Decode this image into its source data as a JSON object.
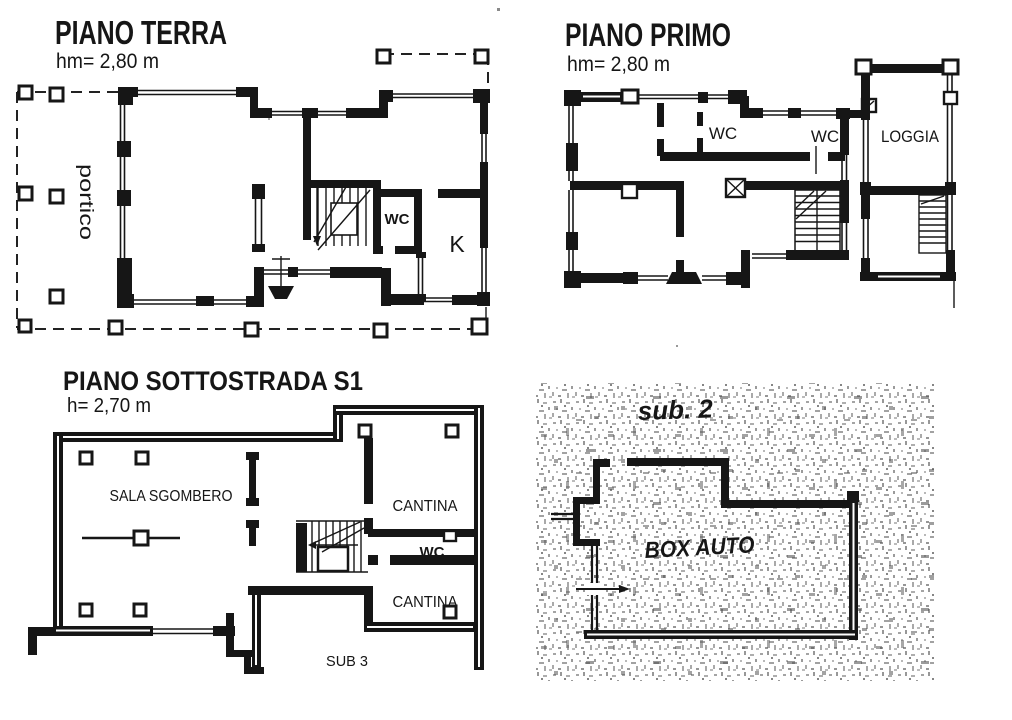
{
  "ink_color": "#161616",
  "plans": {
    "terra": {
      "title": "PIANO TERRA",
      "height_label": "hm= 2,80 m",
      "rooms": {
        "portico": "portico",
        "wc": "WC",
        "kitchen": "K"
      }
    },
    "primo": {
      "title": "PIANO PRIMO",
      "height_label": "hm= 2,80 m",
      "rooms": {
        "wc_1": "WC",
        "wc_2": "WC",
        "loggia": "LOGGIA"
      }
    },
    "sottostrada": {
      "title": "PIANO SOTTOSTRADA S1",
      "height_label": "h= 2,70 m",
      "rooms": {
        "sala_sgombero": "SALA SGOMBERO",
        "cantina_1": "CANTINA",
        "wc": "WC",
        "cantina_2": "CANTINA",
        "sub_3": "SUB 3"
      }
    },
    "sub2": {
      "title": "sub. 2",
      "rooms": {
        "box_auto": "BOX AUTO"
      }
    }
  }
}
